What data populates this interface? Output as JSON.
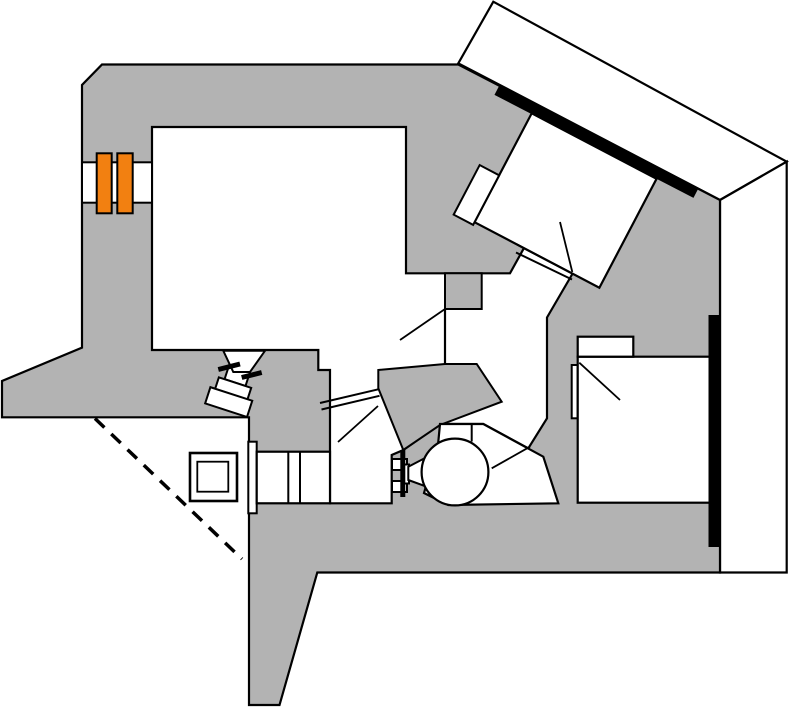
{
  "meta": {
    "description": "Schematic top-view diagram of an experimental apparatus: gray support structure, white rooms and beam corridors, rotated chamber with shielding bars, magnet pair, valves, pump and bellows.",
    "canvas": {
      "width": 789,
      "height": 708
    }
  },
  "palette": {
    "background": "#ffffff",
    "structure_gray": "#b3b3b3",
    "room_white": "#ffffff",
    "outline_black": "#000000",
    "magnet_orange": "#f28011"
  },
  "diagram": {
    "shapes": [
      {
        "name": "rotated-slab-wall",
        "type": "polygon",
        "points": "493.3,1.7 786.7,161.7 720,200 458.3,63.3",
        "fill": "#ffffff",
        "sw": 2.2
      },
      {
        "name": "right-wall-column",
        "type": "polygon",
        "points": "720,200 786.7,161.7 786.7,572.5 720,572.5",
        "fill": "#ffffff",
        "sw": 2.2
      },
      {
        "name": "main-structure-body",
        "type": "polygon",
        "points": "102,64.5 458.3,64.5 720,200 720,572.5 317.3,572.5 279.5,705 249,705 249,417.3 2,417.3 2,381 82,347.7 82,85",
        "fill": "#b3b3b3",
        "sw": 2.2
      },
      {
        "name": "central-room-and-corridors",
        "type": "polygon",
        "points": "152,127 406,127 406,273.3 510,273.3 524,248 573.5,272 547,317.5 547,418.3 528.3,448.3 483.3,424 440,424 403.3,450 391.7,455 391.7,503.3 330,503.3 330,370 318.3,370 318.3,350 152,350",
        "fill": "#ffffff",
        "sw": 2.2
      },
      {
        "name": "gray-wall-protrusion",
        "type": "polygon",
        "points": "445,273.3 481.7,273.3 481.7,309 445,309",
        "fill": "#b3b3b3",
        "sw": 2
      },
      {
        "name": "central-gray-island",
        "type": "polygon",
        "points": "378.3,370 445,364 476.7,364 501.7,401.7 440,425 403.3,450 378.3,388.3",
        "fill": "#b3b3b3",
        "sw": 2
      },
      {
        "name": "partial-wall-line",
        "type": "line",
        "x1": 445,
        "y1": 309,
        "x2": 445,
        "y2": 364,
        "sw": 2.2
      },
      {
        "name": "corridor-port-line-a",
        "type": "line",
        "x1": 320,
        "y1": 403,
        "x2": 378.3,
        "y2": 389.3,
        "sw": 2
      },
      {
        "name": "corridor-port-line-b",
        "type": "line",
        "x1": 321.5,
        "y1": 409.5,
        "x2": 379.5,
        "y2": 395.8,
        "sw": 2
      },
      {
        "name": "leader-line-corridor",
        "type": "line",
        "x1": 445,
        "y1": 309,
        "x2": 400,
        "y2": 340,
        "sw": 1.8
      },
      {
        "name": "leader-line-lower-corridor",
        "type": "line",
        "x1": 338,
        "y1": 442,
        "x2": 378,
        "y2": 406,
        "sw": 1.8
      },
      {
        "name": "bellows-flange",
        "type": "rect",
        "x": 248.3,
        "y": 441.7,
        "w": 8.4,
        "h": 71.6,
        "fill": "#ffffff",
        "sw": 2
      },
      {
        "name": "bellows-body",
        "type": "rect",
        "x": 256.7,
        "y": 451.7,
        "w": 73.3,
        "h": 51.6,
        "fill": "#ffffff",
        "sw": 2.2
      },
      {
        "name": "bellows-divider-1",
        "type": "line",
        "x1": 288.3,
        "y1": 451.7,
        "x2": 288.3,
        "y2": 503.3,
        "sw": 2
      },
      {
        "name": "bellows-divider-2",
        "type": "line",
        "x1": 300,
        "y1": 451.7,
        "x2": 300,
        "y2": 503.3,
        "sw": 2
      },
      {
        "name": "detector-box-outer",
        "type": "rect",
        "x": 190,
        "y": 453,
        "w": 47,
        "h": 48,
        "fill": "#ffffff",
        "sw": 2.6
      },
      {
        "name": "detector-box-inner",
        "type": "rect",
        "x": 197.3,
        "y": 461.7,
        "w": 31,
        "h": 30,
        "fill": "#ffffff",
        "sw": 1.8
      },
      {
        "name": "dashed-sight-line",
        "type": "line",
        "x1": 95,
        "y1": 418.5,
        "x2": 242,
        "y2": 559,
        "sw": 3.5,
        "dash": "13,9.5"
      },
      {
        "name": "tilted-valve-neck",
        "type": "rect",
        "x": 236,
        "y": 360,
        "w": 15,
        "h": 11,
        "fill": "#ffffff",
        "sw": 2,
        "transform": "rotate(18 244 355)"
      },
      {
        "name": "tilted-valve-segment-1",
        "type": "rect",
        "x": 233,
        "y": 368,
        "w": 22,
        "h": 16,
        "fill": "#ffffff",
        "sw": 2,
        "transform": "rotate(18 244 355)"
      },
      {
        "name": "tilted-valve-segment-2",
        "type": "rect",
        "x": 227,
        "y": 384,
        "w": 34,
        "h": 18,
        "fill": "#ffffff",
        "sw": 2,
        "transform": "rotate(18 244 355)"
      },
      {
        "name": "tilted-valve-segment-3",
        "type": "rect",
        "x": 222,
        "y": 396,
        "w": 44,
        "h": 17,
        "fill": "#ffffff",
        "sw": 2,
        "transform": "rotate(18 244 355)"
      },
      {
        "name": "tilted-valve-funnel",
        "type": "polygon",
        "points": "223.3,350.8 265,350.8 250,372 233.3,372",
        "fill": "#ffffff",
        "sw": 2
      },
      {
        "name": "gate-valve-tick-1",
        "type": "line",
        "x1": 218.3,
        "y1": 369.5,
        "x2": 240,
        "y2": 364,
        "sw": 5
      },
      {
        "name": "gate-valve-tick-2",
        "type": "line",
        "x1": 241.7,
        "y1": 377.5,
        "x2": 261.7,
        "y2": 372.5,
        "sw": 5
      },
      {
        "name": "room-door-sliver",
        "type": "rect",
        "x": 571.7,
        "y": 365,
        "w": 6,
        "h": 53.3,
        "fill": "#ffffff",
        "sw": 2
      },
      {
        "name": "bottom-right-room",
        "type": "rect",
        "x": 577.7,
        "y": 356.7,
        "w": 132.3,
        "h": 146,
        "fill": "#ffffff",
        "sw": 2.2
      },
      {
        "name": "bottom-right-room-annex",
        "type": "rect",
        "x": 577.7,
        "y": 336.7,
        "w": 55.6,
        "h": 20,
        "fill": "#ffffff",
        "sw": 2.2
      },
      {
        "name": "leader-line-room",
        "type": "line",
        "x1": 579.3,
        "y1": 362.7,
        "x2": 620,
        "y2": 400,
        "sw": 1.8
      },
      {
        "name": "right-shielding-bar",
        "type": "line",
        "x1": 714.5,
        "y1": 315,
        "x2": 714.5,
        "y2": 547,
        "sw": 12
      },
      {
        "name": "rotated-chamber",
        "type": "rect",
        "x": 531.7,
        "y": 113.3,
        "w": 141,
        "h": 123,
        "fill": "#ffffff",
        "sw": 2.2,
        "transform": "rotate(27.7 531.7 113.3)"
      },
      {
        "name": "chamber-side-port",
        "type": "rect",
        "x": 509.7,
        "y": 183.3,
        "w": 22,
        "h": 56,
        "fill": "#ffffff",
        "sw": 2,
        "transform": "rotate(27.7 531.7 113.3)"
      },
      {
        "name": "chamber-port-line-a",
        "type": "line",
        "x1": 517,
        "y1": 244.5,
        "x2": 570,
        "y2": 272.4,
        "sw": 2
      },
      {
        "name": "chamber-port-line-b",
        "type": "line",
        "x1": 516,
        "y1": 252.5,
        "x2": 572,
        "y2": 279.5,
        "sw": 2
      },
      {
        "name": "leader-line-chamber",
        "type": "line",
        "x1": 560,
        "y1": 222,
        "x2": 572.3,
        "y2": 272,
        "sw": 1.8
      },
      {
        "name": "slab-shielding-bar",
        "type": "line",
        "x1": 497,
        "y1": 90,
        "x2": 696,
        "y2": 193,
        "sw": 11
      },
      {
        "name": "pump-housing",
        "type": "polygon",
        "points": "440,424 483.3,424 543.3,456.7 558.3,503.3 448.3,505 424,493 438,445",
        "fill": "#ffffff",
        "sw": 2.2
      },
      {
        "name": "pump-housing-divider",
        "type": "line",
        "x1": 471.7,
        "y1": 424,
        "x2": 471.7,
        "y2": 441.5,
        "sw": 2
      },
      {
        "name": "valve-flange-tab-upper",
        "type": "rect",
        "x": 392,
        "y": 459,
        "w": 15,
        "h": 11,
        "fill": "#ffffff",
        "sw": 2
      },
      {
        "name": "valve-flange-tab-lower",
        "type": "rect",
        "x": 392,
        "y": 481,
        "w": 15,
        "h": 11,
        "fill": "#ffffff",
        "sw": 2
      },
      {
        "name": "valve-stem",
        "type": "rect",
        "x": 404,
        "y": 464.5,
        "w": 5,
        "h": 19,
        "fill": "#ffffff",
        "sw": 2
      },
      {
        "name": "gate-valve-bar",
        "type": "line",
        "x1": 402.8,
        "y1": 450,
        "x2": 402.8,
        "y2": 497,
        "sw": 5
      },
      {
        "name": "pump-inlet-funnel",
        "type": "polygon",
        "points": "408.3,466.7 426,457.5 426,486.5 408.3,480",
        "fill": "#ffffff",
        "sw": 2
      },
      {
        "name": "pump-circle",
        "type": "circle",
        "cx": 455,
        "cy": 472,
        "r": 33.4,
        "fill": "#ffffff",
        "sw": 2.2
      },
      {
        "name": "leader-line-pump",
        "type": "line",
        "x1": 530,
        "y1": 446.7,
        "x2": 491.7,
        "y2": 468.3,
        "sw": 1.8
      },
      {
        "name": "beam-wall-gap",
        "type": "rect",
        "x": 82,
        "y": 162.3,
        "w": 70,
        "h": 40.4,
        "fill": "#ffffff",
        "sw": 2
      },
      {
        "name": "magnet-block-1",
        "type": "rect",
        "x": 96.7,
        "y": 153.3,
        "w": 15,
        "h": 60,
        "fill": "#f28011",
        "sw": 2
      },
      {
        "name": "magnet-block-2",
        "type": "rect",
        "x": 117.3,
        "y": 153.3,
        "w": 15.4,
        "h": 60,
        "fill": "#f28011",
        "sw": 2
      }
    ]
  }
}
